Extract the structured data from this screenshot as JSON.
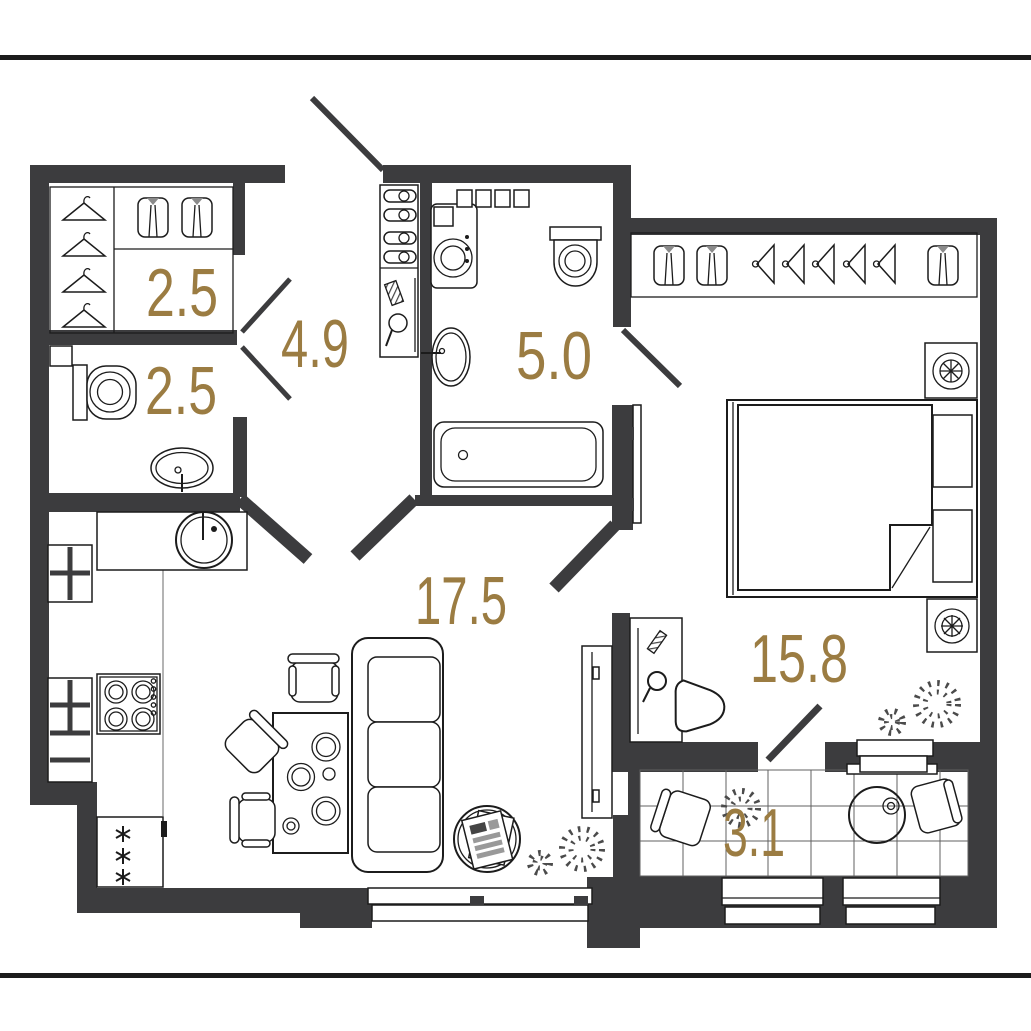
{
  "plan": {
    "type": "apartment-floor-plan",
    "rooms": [
      {
        "name": "dressing-room",
        "area": "2.5"
      },
      {
        "name": "hallway",
        "area": "4.9"
      },
      {
        "name": "wc",
        "area": "2.5"
      },
      {
        "name": "bathroom",
        "area": "5.0"
      },
      {
        "name": "kitchen-living",
        "area": "17.5"
      },
      {
        "name": "bedroom",
        "area": "15.8"
      },
      {
        "name": "balcony",
        "area": "3.1"
      }
    ],
    "colors": {
      "wall": "#3c3c3e",
      "ink": "#1c1c1c",
      "label": "#9b7c42",
      "sep": "#1c1c1c",
      "background": "#ffffff"
    }
  }
}
